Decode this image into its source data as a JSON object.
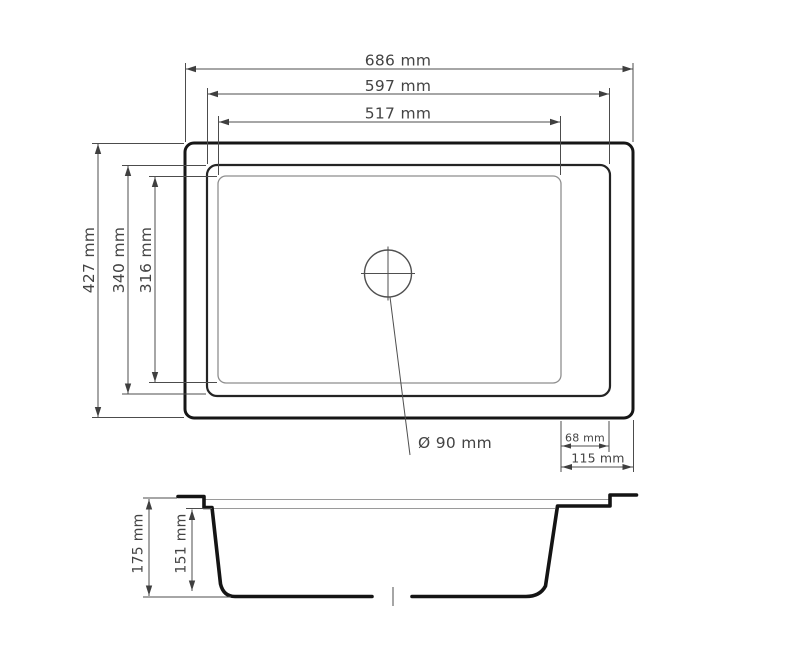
{
  "dimensions": {
    "overall_width": "686 mm",
    "rim_width": "597 mm",
    "bowl_width": "517 mm",
    "overall_depth": "427 mm",
    "rim_depth": "340 mm",
    "bowl_depth": "316 mm",
    "drain_diameter": "Ø 90 mm",
    "drain_to_rim_offset": "68 mm",
    "drain_to_edge_offset": "115 mm",
    "overall_height": "175 mm",
    "bowl_inner_depth": "151 mm"
  },
  "colors": {
    "outline": "#161616",
    "dimension_lines": "#4c4c4c",
    "bowl_inner_outline": "#8e8e8e",
    "background": "#ffffff"
  }
}
